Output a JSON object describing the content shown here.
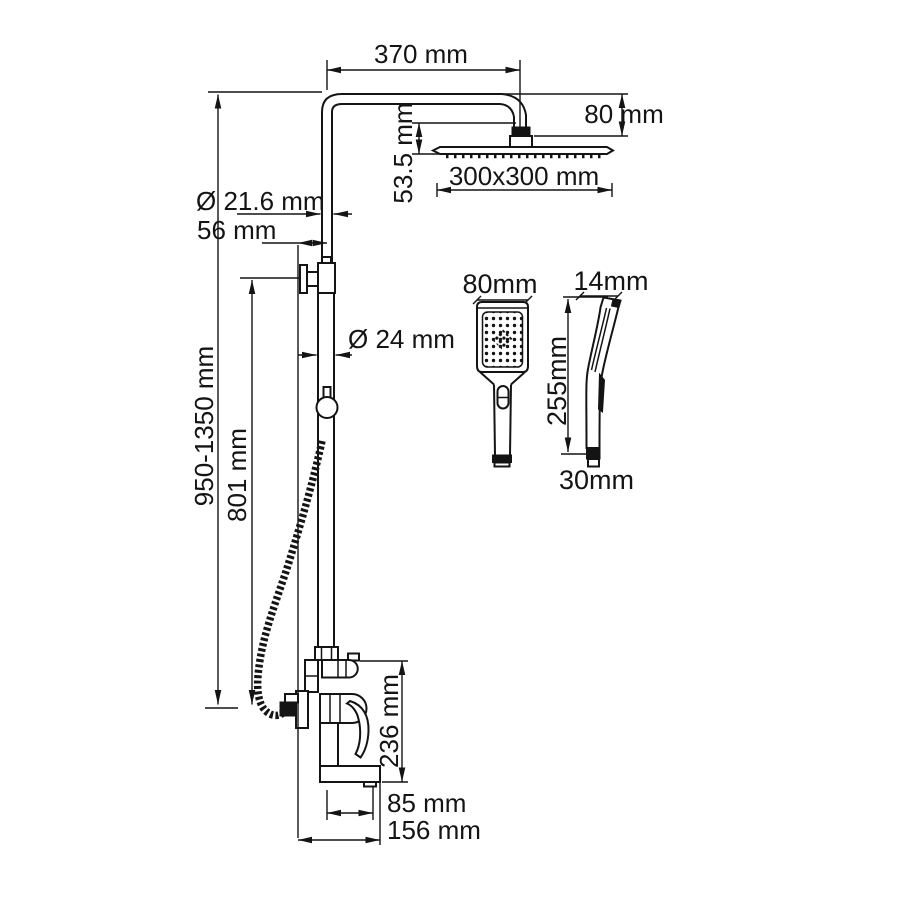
{
  "drawing": {
    "kind": "shower-system-technical-drawing",
    "colors": {
      "line": "#141414",
      "background": "#ffffff"
    },
    "labels": {
      "arm_length": "370 mm",
      "head_drop": "80 mm",
      "head_offset": "53.5 mm",
      "head_size": "300x300 mm",
      "pipe_upper_diameter": "Ø 21.6 mm",
      "wall_offset": "56 mm",
      "pipe_lower_diameter": "Ø 24 mm",
      "column_height": "950-1350 mm",
      "bracket_height": "801 mm",
      "mixer_height": "236 mm",
      "spout_reach": "85 mm",
      "total_depth": "156 mm"
    },
    "handshower": {
      "head_width": "80mm",
      "head_depth": "14mm",
      "length": "255mm",
      "handle_width": "30mm"
    }
  }
}
